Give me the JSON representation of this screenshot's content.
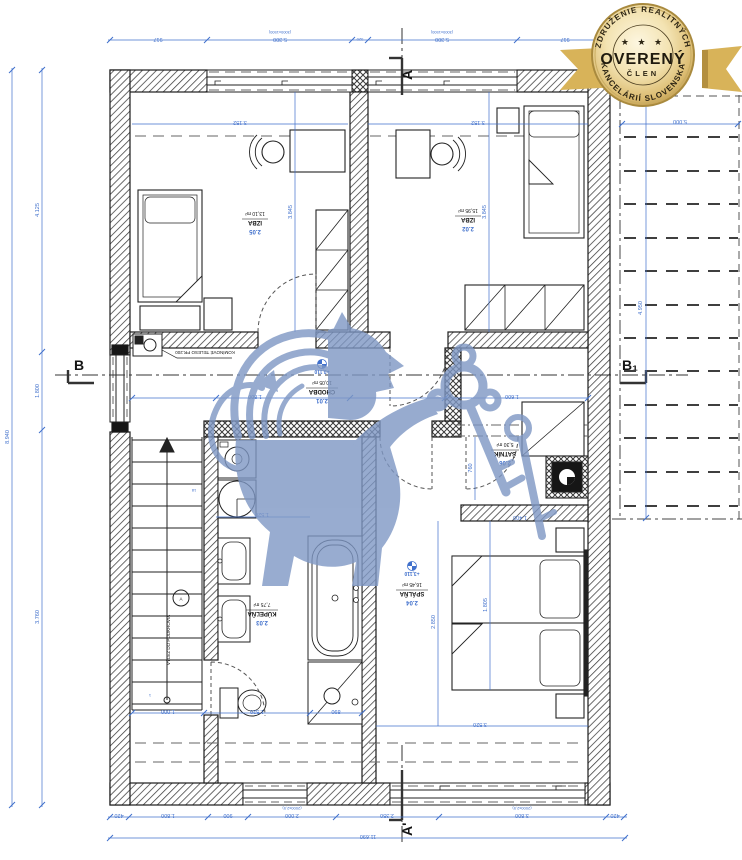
{
  "badge": {
    "top_arc": "ZDRUŽENIE REALITNÝCH",
    "bottom_arc": "KANCELÁRIÍ SLOVENSKA",
    "stars": "★ ★ ★",
    "center": "OVERENÝ",
    "sub": "ČLEN",
    "gold": "#d8b359",
    "gold_dark": "#b38f3f"
  },
  "sections": {
    "a_top": "A",
    "a_bottom": "A'",
    "b_left": "B",
    "b_right": "B₁"
  },
  "rooms": {
    "izba_tl": {
      "num": "2.05",
      "name": "IZBA",
      "area": "13,10 m²"
    },
    "izba_tr": {
      "num": "2.02",
      "name": "IZBA",
      "area": "15,95 m²"
    },
    "chodba": {
      "num": "2.01",
      "name": "CHODBA",
      "area": "10,05 m²"
    },
    "satnik": {
      "num": "2.06",
      "name": "ŠATNÍK",
      "area": "5,30 m²"
    },
    "kupelna": {
      "num": "2.03",
      "name": "KÚPEĽŇA",
      "area": "7,75 m²"
    },
    "spalna": {
      "num": "2.04",
      "name": "SPÁLŇA",
      "area": "16,45 m²"
    }
  },
  "elevation": {
    "value": "+3,110"
  },
  "annotations": {
    "chimney": "KOMÍNOVÉ TELESO PR.200",
    "attic": "VÝLEZ DO PODKROVIA",
    "attic_marker": "A",
    "step_top": "18",
    "step_bottom": "1"
  },
  "colors": {
    "dim_blue": "#4070cc",
    "line_black": "#1c1c1c",
    "watermark_blue": "#7e97c4"
  },
  "dimensions": {
    "texts": [
      {
        "v": "917",
        "x": 158,
        "y": 38,
        "r": 180
      },
      {
        "v": "5.300",
        "x": 280,
        "y": 38,
        "r": 180
      },
      {
        "v": "520",
        "x": 360,
        "y": 38,
        "r": 180,
        "s": 1
      },
      {
        "v": "5.300",
        "x": 442,
        "y": 38,
        "r": 180
      },
      {
        "v": "917",
        "x": 565,
        "y": 38,
        "r": 180
      },
      {
        "v": "(3000x1500)",
        "x": 280,
        "y": 31,
        "r": 180,
        "s": 1
      },
      {
        "v": "(3000x1500)",
        "x": 442,
        "y": 31,
        "r": 180,
        "s": 1
      },
      {
        "v": "420",
        "x": 119,
        "y": 814,
        "r": 180
      },
      {
        "v": "1.800",
        "x": 168,
        "y": 814,
        "r": 180
      },
      {
        "v": "900",
        "x": 228,
        "y": 814,
        "r": 180
      },
      {
        "v": "2.000",
        "x": 292,
        "y": 814,
        "r": 180
      },
      {
        "v": "2.350",
        "x": 387,
        "y": 814,
        "r": 180
      },
      {
        "v": "3.800",
        "x": 522,
        "y": 814,
        "r": 180
      },
      {
        "v": "420",
        "x": 615,
        "y": 814,
        "r": 180
      },
      {
        "v": "(2000x2,5)",
        "x": 292,
        "y": 807,
        "r": 180,
        "s": 1
      },
      {
        "v": "(2000x2,5)",
        "x": 522,
        "y": 807,
        "r": 180,
        "s": 1
      },
      {
        "v": "11.690",
        "x": 368,
        "y": 835,
        "r": 180
      },
      {
        "v": "8.940",
        "x": 9,
        "y": 437,
        "r": -90
      },
      {
        "v": "4.125",
        "x": 39,
        "y": 210,
        "r": -90
      },
      {
        "v": "1.800",
        "x": 39,
        "y": 391,
        "r": -90
      },
      {
        "v": "3.760",
        "x": 39,
        "y": 617,
        "r": -90
      },
      {
        "v": "5.000",
        "x": 680,
        "y": 120,
        "r": 180
      },
      {
        "v": "4.950",
        "x": 642,
        "y": 308,
        "r": -90
      },
      {
        "v": "3.152",
        "x": 240,
        "y": 121,
        "r": 180
      },
      {
        "v": "3.152",
        "x": 478,
        "y": 121,
        "r": 180
      },
      {
        "v": "3.845",
        "x": 292,
        "y": 212,
        "r": -90
      },
      {
        "v": "3.845",
        "x": 486,
        "y": 212,
        "r": -90
      },
      {
        "v": "1.800",
        "x": 255,
        "y": 395,
        "r": 180
      },
      {
        "v": "1.600",
        "x": 512,
        "y": 395,
        "r": 180
      },
      {
        "v": "1.520",
        "x": 262,
        "y": 513,
        "r": 180
      },
      {
        "v": "1.000",
        "x": 168,
        "y": 710,
        "r": 180
      },
      {
        "v": "1.520",
        "x": 257,
        "y": 710,
        "r": 180
      },
      {
        "v": "890",
        "x": 336,
        "y": 710,
        "r": 180
      },
      {
        "v": "3.520",
        "x": 480,
        "y": 723,
        "r": 180
      },
      {
        "v": "2.850",
        "x": 435,
        "y": 622,
        "r": -90
      },
      {
        "v": "1.805",
        "x": 487,
        "y": 605,
        "r": -90
      },
      {
        "v": "1.400",
        "x": 520,
        "y": 516,
        "r": 180
      },
      {
        "v": "760",
        "x": 472,
        "y": 468,
        "r": -90
      },
      {
        "v": "18",
        "x": 194,
        "y": 489,
        "r": 180,
        "s": 1
      },
      {
        "v": "1",
        "x": 150,
        "y": 694,
        "r": 180,
        "s": 1
      }
    ]
  }
}
